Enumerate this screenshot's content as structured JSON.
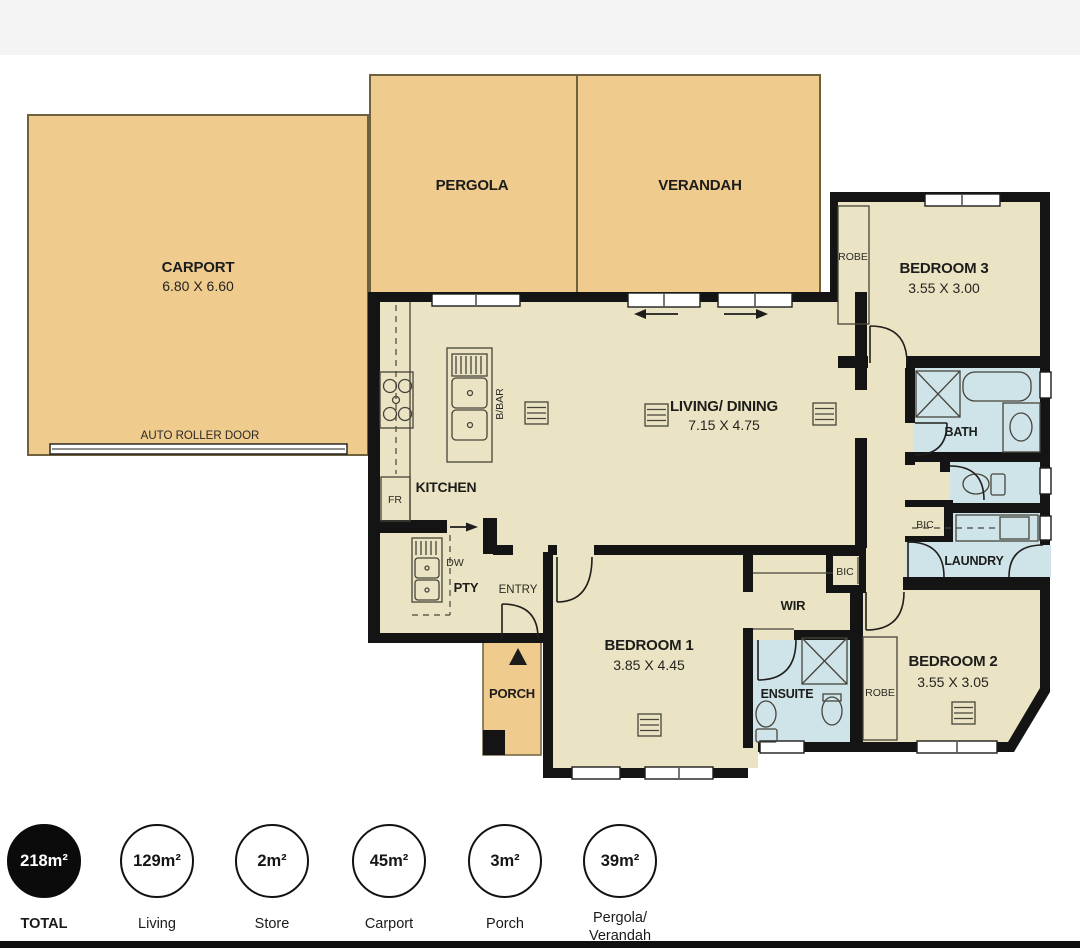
{
  "colors": {
    "outdoor": "#f0cb8e",
    "interior": "#ebe4c4",
    "wet": "#cfe4e9",
    "wall": "#141414",
    "legend_filled": "#0b0b0b"
  },
  "plan": {
    "carport": {
      "name": "CARPORT",
      "dims": "6.80 X 6.60"
    },
    "pergola": {
      "name": "PERGOLA"
    },
    "verandah": {
      "name": "VERANDAH"
    },
    "living": {
      "name": "LIVING/ DINING",
      "dims": "7.15 X 4.75"
    },
    "kitchen": {
      "name": "KITCHEN"
    },
    "bedroom1": {
      "name": "BEDROOM 1",
      "dims": "3.85 X 4.45"
    },
    "bedroom2": {
      "name": "BEDROOM 2",
      "dims": "3.55 X 3.05"
    },
    "bedroom3": {
      "name": "BEDROOM 3",
      "dims": "3.55 X 3.00"
    },
    "bath": {
      "name": "BATH"
    },
    "laundry": {
      "name": "LAUNDRY"
    },
    "ensuite": {
      "name": "ENSUITE"
    },
    "wir": {
      "name": "WIR"
    },
    "porch": {
      "name": "PORCH"
    },
    "pty": {
      "name": "PTY"
    },
    "entry": {
      "name": "ENTRY"
    },
    "labels": {
      "fr": "FR",
      "dw": "DW",
      "bbar": "B/BAR",
      "robe_bed3": "ROBE",
      "robe_bed2": "ROBE",
      "bic_hall": "BIC",
      "bic_wir": "BIC",
      "auto_roller_door": "AUTO ROLLER DOOR"
    }
  },
  "legend": {
    "items": [
      {
        "value": "218m²",
        "label": "TOTAL",
        "label2": "",
        "filled": true
      },
      {
        "value": "129m²",
        "label": "Living",
        "label2": ""
      },
      {
        "value": "2m²",
        "label": "Store",
        "label2": ""
      },
      {
        "value": "45m²",
        "label": "Carport",
        "label2": ""
      },
      {
        "value": "3m²",
        "label": "Porch",
        "label2": ""
      },
      {
        "value": "39m²",
        "label": "Pergola/",
        "label2": "Verandah"
      }
    ]
  }
}
